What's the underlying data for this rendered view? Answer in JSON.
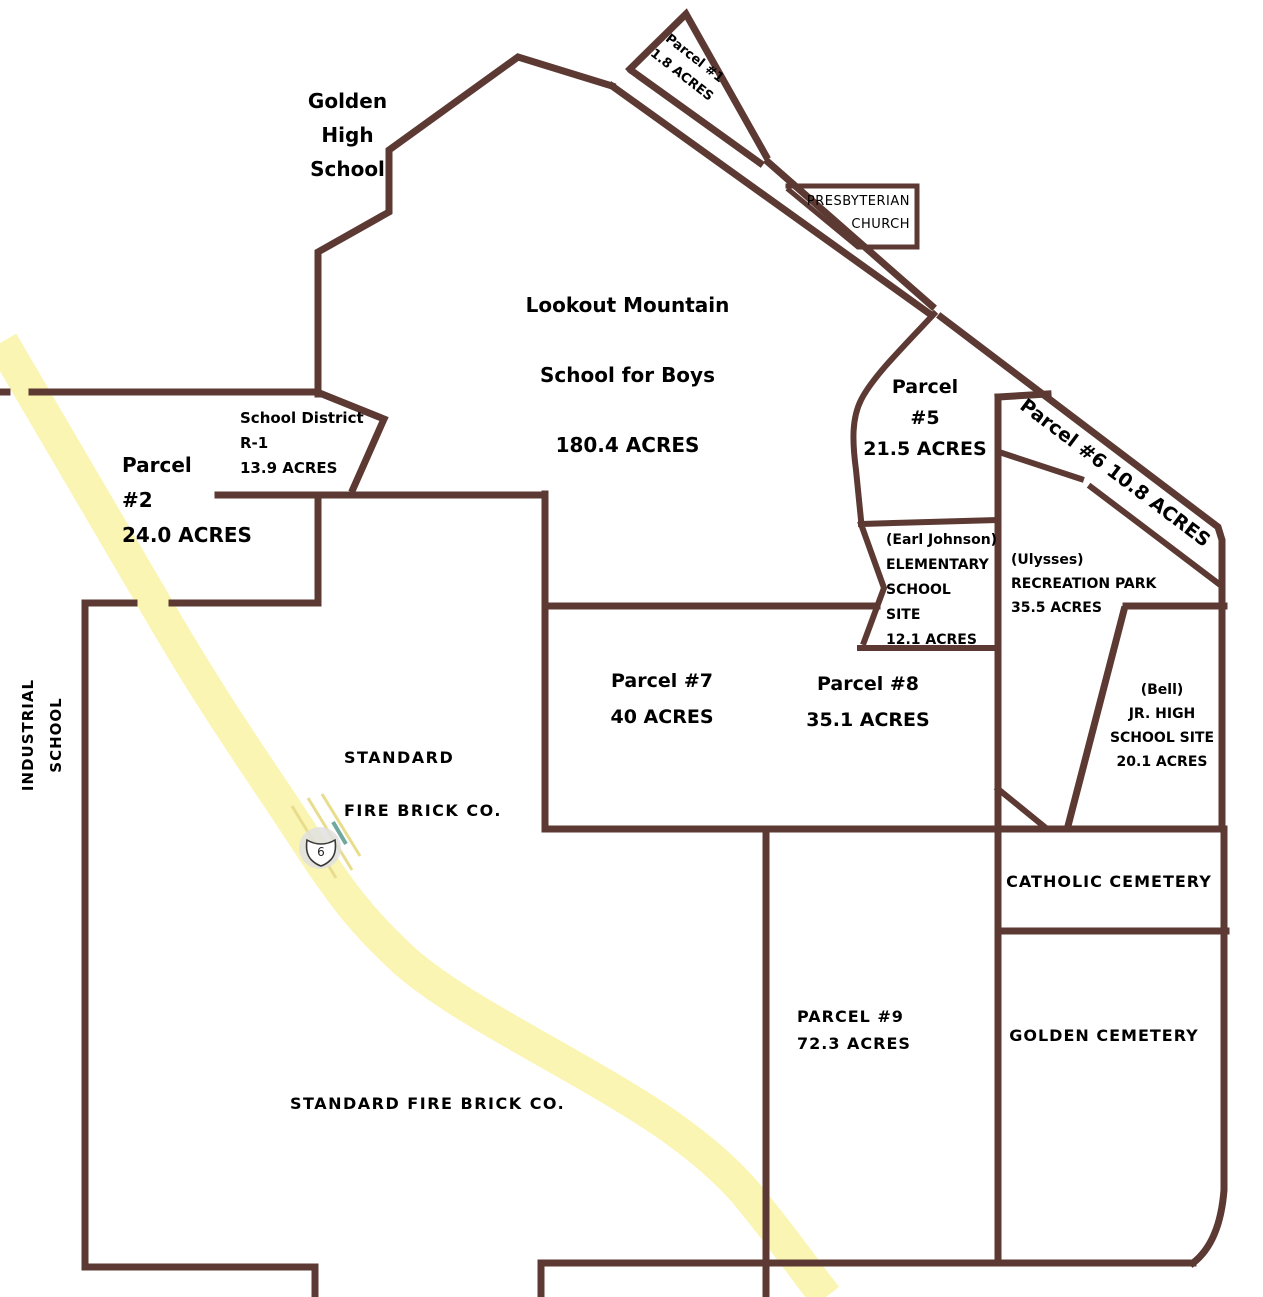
{
  "colors": {
    "boundary": "#5c3a33",
    "road_fill": "#faf5b2",
    "road_stripe": "#e9dd8d",
    "teal_dash": "#6fa89e",
    "shield_halo": "#e0e0e0",
    "shield_fill": "#ffffff",
    "text": "#000000",
    "background": "#ffffff"
  },
  "road": {
    "route_number": "6"
  },
  "labels": {
    "golden_high_school": {
      "lines": [
        "Golden",
        "High",
        "School"
      ]
    },
    "parcel_1": {
      "lines": [
        "Parcel #1",
        "1.8 ACRES"
      ]
    },
    "presbyterian_church": {
      "lines": [
        "PRESBYTERIAN",
        "CHURCH"
      ]
    },
    "lookout_mountain": {
      "lines": [
        "Lookout Mountain",
        "School for Boys",
        "180.4 ACRES"
      ]
    },
    "school_district_r1": {
      "lines": [
        "School District",
        "R-1",
        "13.9 ACRES"
      ]
    },
    "parcel_2": {
      "lines": [
        "Parcel",
        "#2",
        "24.0 ACRES"
      ]
    },
    "parcel_5": {
      "lines": [
        "Parcel",
        "#5",
        "21.5 ACRES"
      ]
    },
    "parcel_6": {
      "lines": [
        "Parcel #6 10.8 ACRES"
      ]
    },
    "earl_johnson_elementary": {
      "lines": [
        "(Earl Johnson)",
        "ELEMENTARY",
        "SCHOOL",
        "SITE",
        "12.1 ACRES"
      ]
    },
    "ulysses_recreation_park": {
      "lines": [
        "(Ulysses)",
        "RECREATION PARK",
        "35.5 ACRES"
      ]
    },
    "parcel_7": {
      "lines": [
        "Parcel #7",
        "40 ACRES"
      ]
    },
    "parcel_8": {
      "lines": [
        "Parcel #8",
        "35.1 ACRES"
      ]
    },
    "bell_jr_high": {
      "lines": [
        "(Bell)",
        "JR. HIGH",
        "SCHOOL SITE",
        "20.1 ACRES"
      ]
    },
    "standard_fire_brick_upper": {
      "lines": [
        "STANDARD",
        "FIRE BRICK CO."
      ]
    },
    "catholic_cemetery": {
      "lines": [
        "CATHOLIC CEMETERY"
      ]
    },
    "parcel_9": {
      "lines": [
        "PARCEL #9",
        "72.3 ACRES"
      ]
    },
    "golden_cemetery": {
      "lines": [
        "GOLDEN CEMETERY"
      ]
    },
    "standard_fire_brick_lower": {
      "lines": [
        "STANDARD FIRE BRICK CO."
      ]
    },
    "industrial_school": {
      "lines": [
        "INDUSTRIAL",
        "SCHOOL"
      ]
    }
  }
}
